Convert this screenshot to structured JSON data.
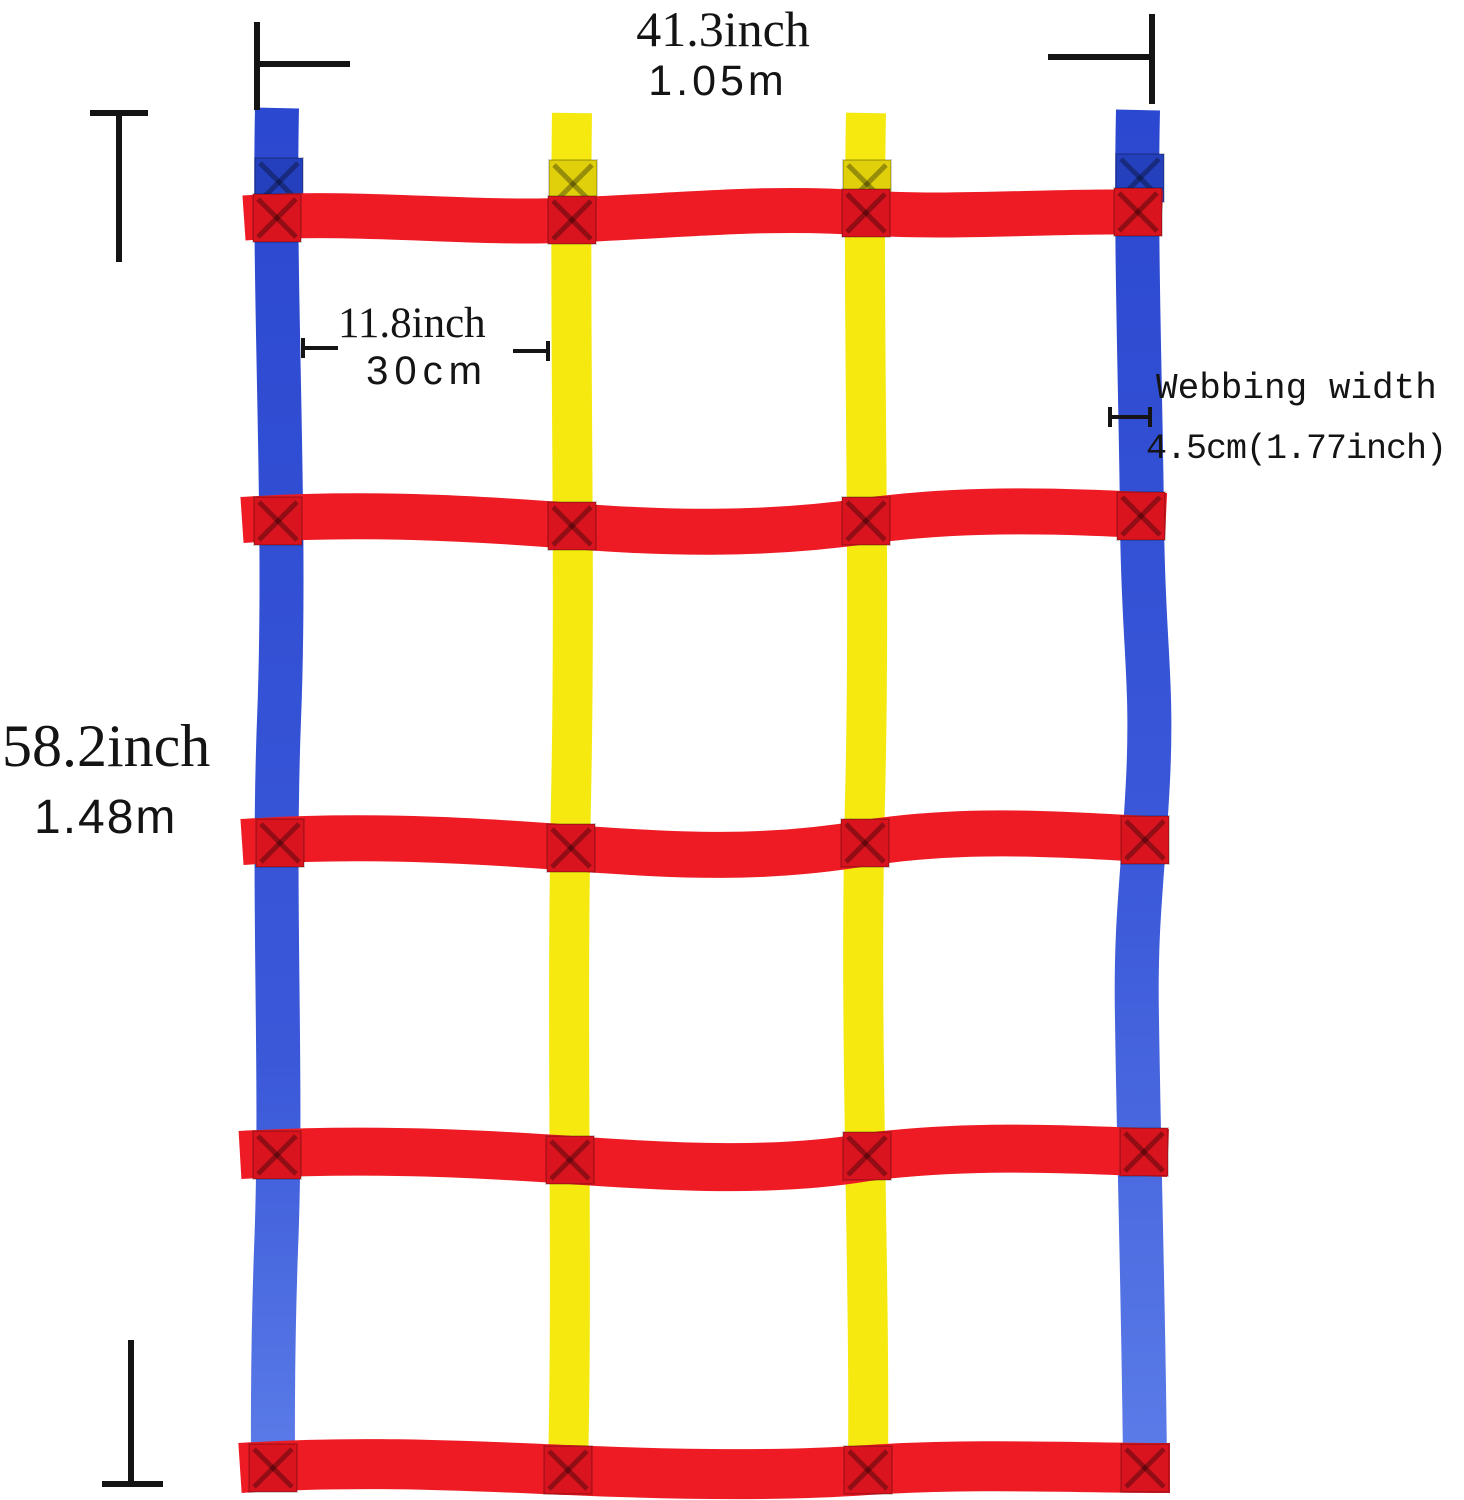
{
  "diagram": {
    "subject": "colorful webbing climbing net with dimension annotations",
    "vertical_straps": [
      "blue-left",
      "yellow-1",
      "yellow-2",
      "blue-right"
    ],
    "horizontal_red_straps": 5
  },
  "labels": {
    "width": {
      "imperial": "41.3inch",
      "metric": "1.05m"
    },
    "height": {
      "imperial": "58.2inch",
      "metric": "1.48m"
    },
    "grid_spacing": {
      "imperial": "11.8inch",
      "metric": "30cm"
    },
    "webbing": {
      "line1": "Webbing width",
      "line2": "4.5cm(1.77inch)"
    }
  },
  "colors": {
    "red": "#ee1b24",
    "red_box": "#d9141f",
    "yellow": "#f5e90f",
    "yellow_box": "#e0d00c",
    "blue_top": "#2b48d0",
    "blue_mid": "#3a58d8",
    "blue_bottom": "#5b7ce8",
    "blue_box": "#2440bd",
    "line": "#141414",
    "background": "#ffffff"
  }
}
